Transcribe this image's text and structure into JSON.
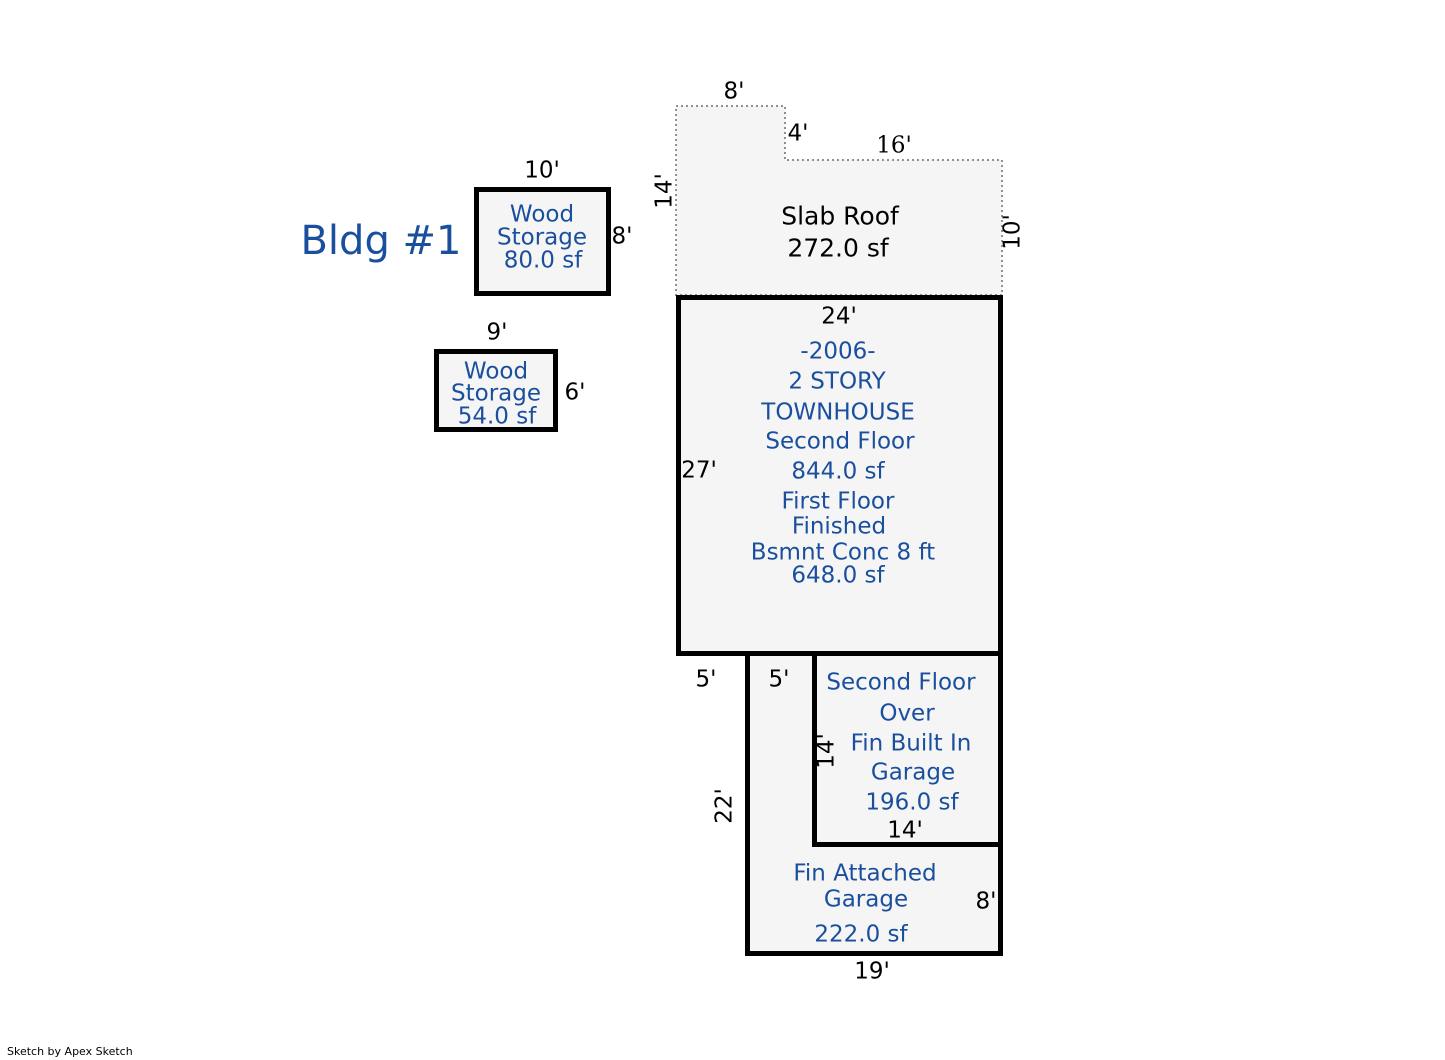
{
  "title": "Bldg #1",
  "footer_credit": "Sketch by Apex Sketch",
  "colors": {
    "label_blue": "#1A4F9E",
    "dim_black": "#000000",
    "shape_fill": "#F5F5F5",
    "wall_black": "#000000",
    "dotted_gray": "#909090"
  },
  "areas": {
    "wood_storage_80": {
      "lines": [
        "Wood",
        "Storage",
        "80.0 sf"
      ],
      "dims": {
        "top": "10'",
        "right": "8'"
      }
    },
    "wood_storage_54": {
      "lines": [
        "Wood",
        "Storage",
        "54.0 sf"
      ],
      "dims": {
        "top": "9'",
        "right": "6'"
      }
    },
    "slab_roof": {
      "lines": [
        "Slab Roof",
        "272.0 sf"
      ],
      "dims": {
        "top_left": "8'",
        "notch": "4'",
        "top_right": "16'",
        "left": "14'",
        "right": "10'"
      }
    },
    "townhouse": {
      "lines": [
        "-2006-",
        "2 STORY",
        "TOWNHOUSE",
        "Second Floor",
        "844.0 sf",
        "First Floor",
        "Finished",
        "Bsmnt Conc 8 ft",
        "648.0 sf"
      ],
      "dims": {
        "top": "24'",
        "left": "27'"
      }
    },
    "second_floor_over_garage": {
      "lines": [
        "Second Floor",
        "Over",
        "Fin Built In",
        "Garage",
        "196.0 sf"
      ],
      "dims": {
        "left": "14'",
        "bottom": "14'"
      }
    },
    "fin_attached_garage": {
      "lines": [
        "Fin Attached",
        "Garage",
        "222.0 sf"
      ],
      "dims": {
        "offset_left": "5'",
        "strip_width": "5'",
        "left": "22'",
        "right": "8'",
        "bottom": "19'"
      }
    }
  }
}
